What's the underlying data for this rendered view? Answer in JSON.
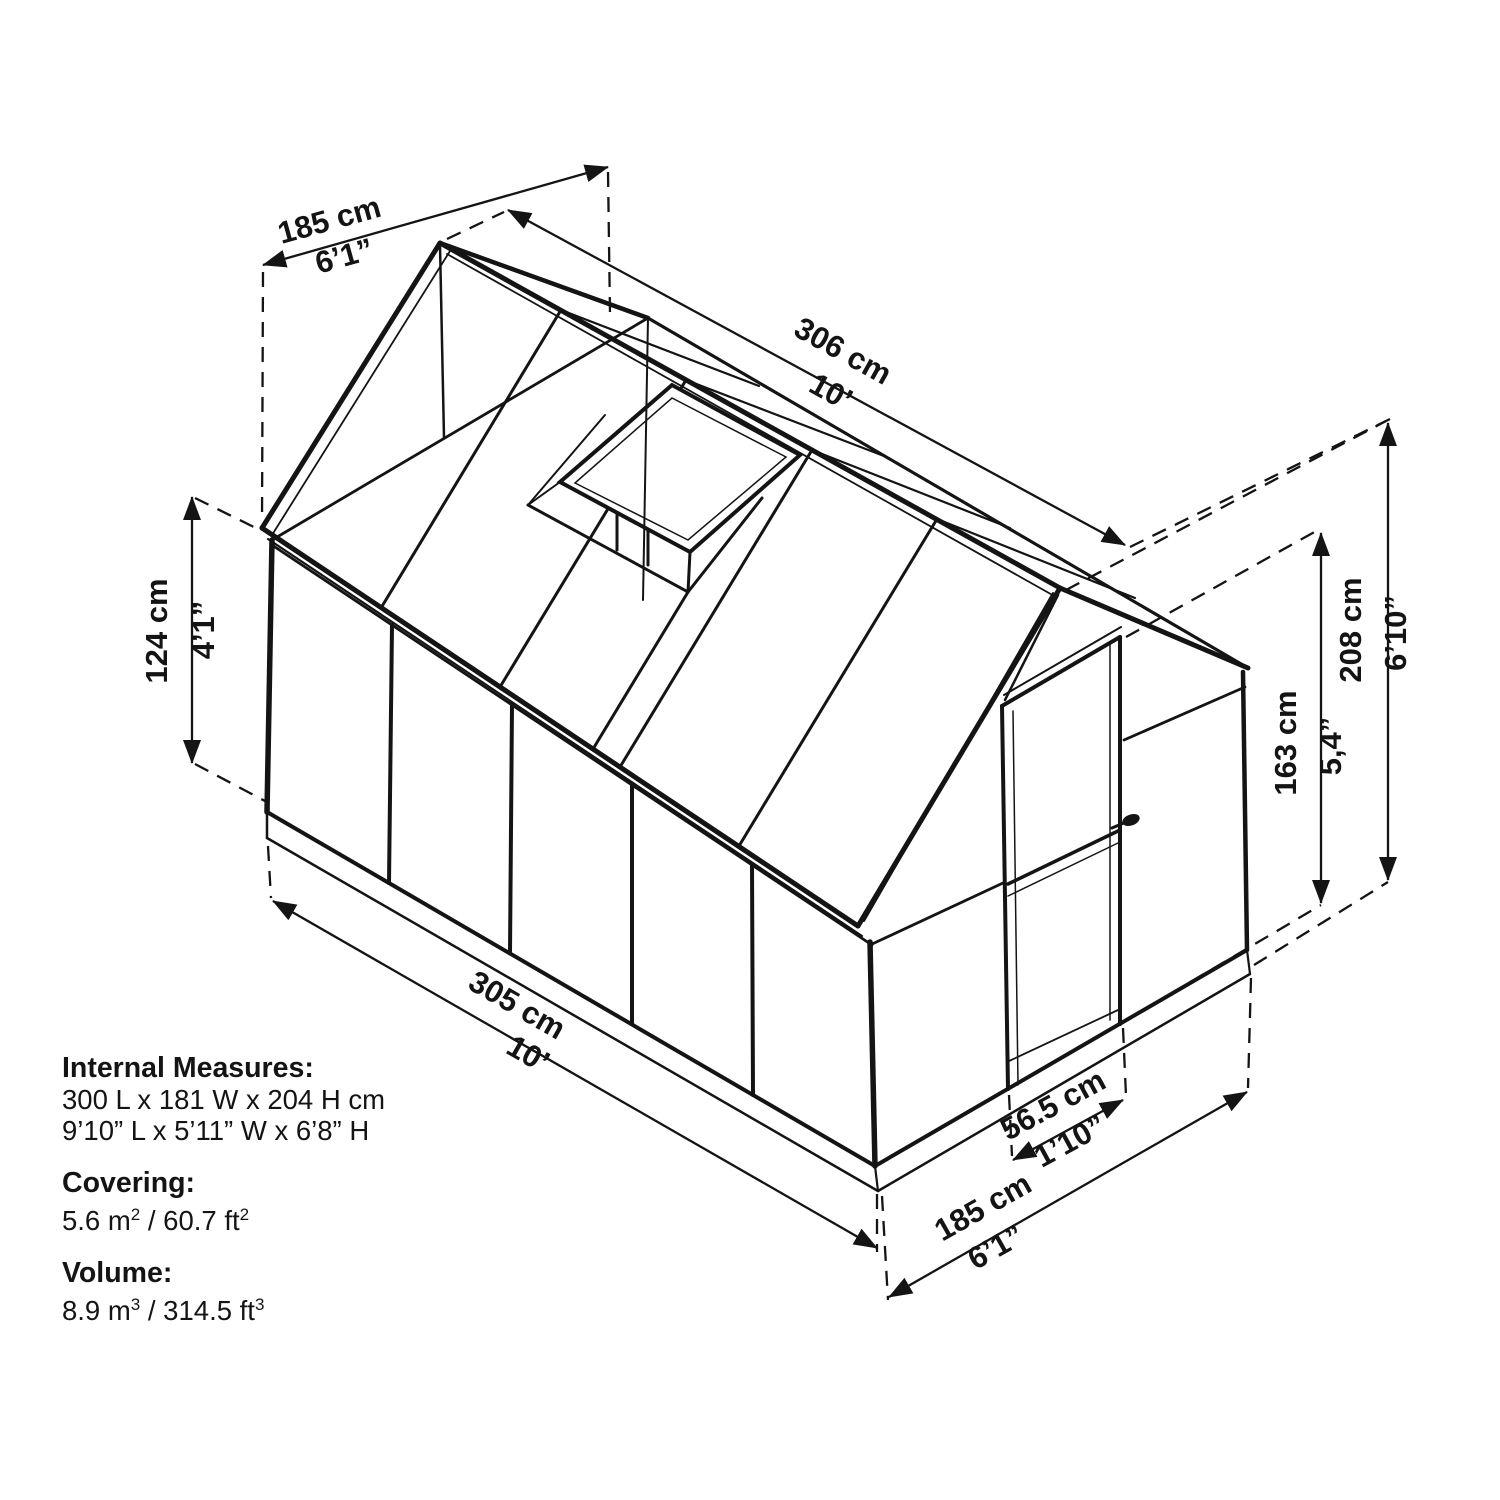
{
  "diagram_title": "greenhouse-dimensions-diagram",
  "colors": {
    "line": "#141414",
    "background": "#ffffff"
  },
  "dims": {
    "back_width": {
      "metric": "185 cm",
      "imperial": "6’1”"
    },
    "ridge_length": {
      "metric": "306 cm",
      "imperial": "10’"
    },
    "eave_height": {
      "metric": "124 cm",
      "imperial": "4’1”"
    },
    "door_height": {
      "metric": "163 cm",
      "imperial": "5,4”"
    },
    "total_height": {
      "metric": "208 cm",
      "imperial": "6’10”"
    },
    "base_length": {
      "metric": "305 cm",
      "imperial": "10’"
    },
    "front_width": {
      "metric": "185 cm",
      "imperial": "6’1”"
    },
    "door_width": {
      "metric": "56.5 cm",
      "imperial": "1’10”"
    }
  },
  "specs": {
    "internal_label": "Internal Measures:",
    "internal_metric": "300 L x 181 W x 204 H cm",
    "internal_imperial": "9’10” L x 5’11” W x 6’8” H",
    "covering_label": "Covering:",
    "covering": {
      "m": "5.6 m",
      "m_sup": "2",
      "ft": " / 60.7 ft",
      "ft_sup": "2"
    },
    "volume_label": "Volume:",
    "volume": {
      "m": "8.9 m",
      "m_sup": "3",
      "ft": " / 314.5 ft",
      "ft_sup": "3"
    }
  }
}
